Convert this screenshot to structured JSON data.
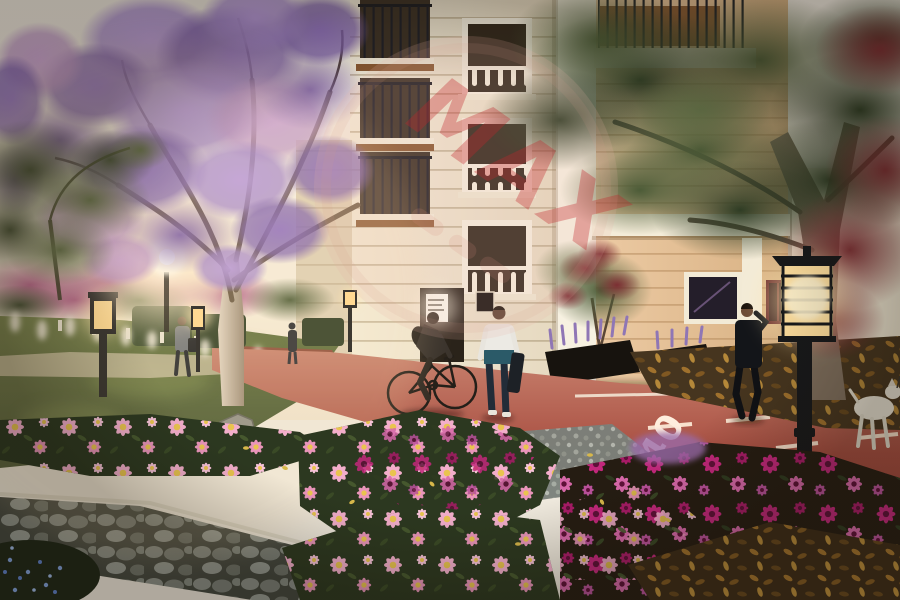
{
  "meta": {
    "type": "architectural-render",
    "description": "Sunset 3D rendering of a residential compound garden with blooming jacaranda tree, pink flower beds, red bike lane, classical apartment building, street lanterns, pedestrians, a cyclist and a white dog"
  },
  "watermark": {
    "text": "MAX",
    "text_color": "#c0272d",
    "balloon_color": "#e8b2a6"
  },
  "road": {
    "marking_text": "40",
    "marking_color": "#ffeedd",
    "surface_color": "#a7493f"
  },
  "palette": {
    "sky": "#f6efe3",
    "building_cream": "#f0e7d4",
    "building_tan": "#e4c096",
    "grass": "#55663a",
    "jacaranda_purple": "#9e83c8",
    "daisy_pink": "#f3aecb",
    "gerbera_magenta": "#c2277b",
    "lamp_glow": "#ffdf9e",
    "foliage_dark": "#2c3a26",
    "foliage_red": "#7c2b31",
    "cobblestone": "#7b807a"
  },
  "scene_objects": {
    "people": [
      "cyclist",
      "pedestrian-with-bag",
      "man-in-suit-on-phone",
      "distant-walker",
      "tiny-distant-figure"
    ],
    "animals": [
      "white-dog-on-leash"
    ],
    "landscape": [
      "jacaranda-tree",
      "dark-green-tree",
      "red-maple-foliage",
      "bougainvillea-hedge",
      "pampas-grass",
      "flower-beds",
      "lavender-planters",
      "lawn",
      "boulder"
    ],
    "hardscape": [
      "apartment-building",
      "red-bike-lane",
      "cobblestone-path",
      "pebble-patch",
      "street-lanterns",
      "white-bollards",
      "fallen-leaves"
    ]
  }
}
